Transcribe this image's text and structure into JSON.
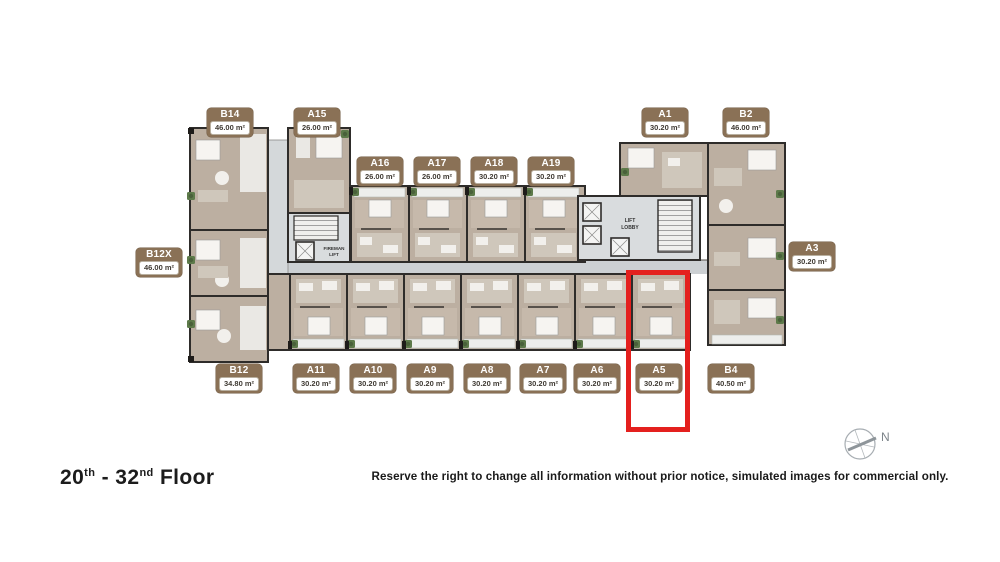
{
  "colors": {
    "badge_brown": "#8a7156",
    "room_fill": "#bcafa1",
    "room_light": "#cfc7bb",
    "corridor_gray": "#ccd0d3",
    "wall_dark": "#2e2c2a",
    "highlight_red": "#e4201e",
    "plant_green": "#5d7a4a"
  },
  "plan": {
    "fireman_lift_label": [
      "FIREMAN",
      "LIFT"
    ],
    "lift_lobby_label": [
      "LIFT",
      "LOBBY"
    ],
    "north_label": "N"
  },
  "units": [
    {
      "id": "B14",
      "area": "46.00 m²"
    },
    {
      "id": "A15",
      "area": "26.00 m²"
    },
    {
      "id": "A16",
      "area": "26.00 m²"
    },
    {
      "id": "A17",
      "area": "26.00 m²"
    },
    {
      "id": "A18",
      "area": "30.20 m²"
    },
    {
      "id": "A19",
      "area": "30.20 m²"
    },
    {
      "id": "A1",
      "area": "30.20 m²"
    },
    {
      "id": "B2",
      "area": "46.00 m²"
    },
    {
      "id": "B12X",
      "area": "46.00 m²"
    },
    {
      "id": "A3",
      "area": "30.20 m²"
    },
    {
      "id": "B12",
      "area": "34.80 m²"
    },
    {
      "id": "A11",
      "area": "30.20 m²"
    },
    {
      "id": "A10",
      "area": "30.20 m²"
    },
    {
      "id": "A9",
      "area": "30.20 m²"
    },
    {
      "id": "A8",
      "area": "30.20 m²"
    },
    {
      "id": "A7",
      "area": "30.20 m²"
    },
    {
      "id": "A6",
      "area": "30.20 m²"
    },
    {
      "id": "A5",
      "area": "30.20 m²",
      "highlighted": true
    },
    {
      "id": "B4",
      "area": "40.50 m²"
    }
  ],
  "footer": {
    "floor_from": "20",
    "floor_from_ord": "th",
    "floor_sep": "-",
    "floor_to": "32",
    "floor_to_ord": "nd",
    "floor_suffix": "Floor",
    "disclaimer": "Reserve the right to change all information without prior notice, simulated images for commercial only."
  }
}
